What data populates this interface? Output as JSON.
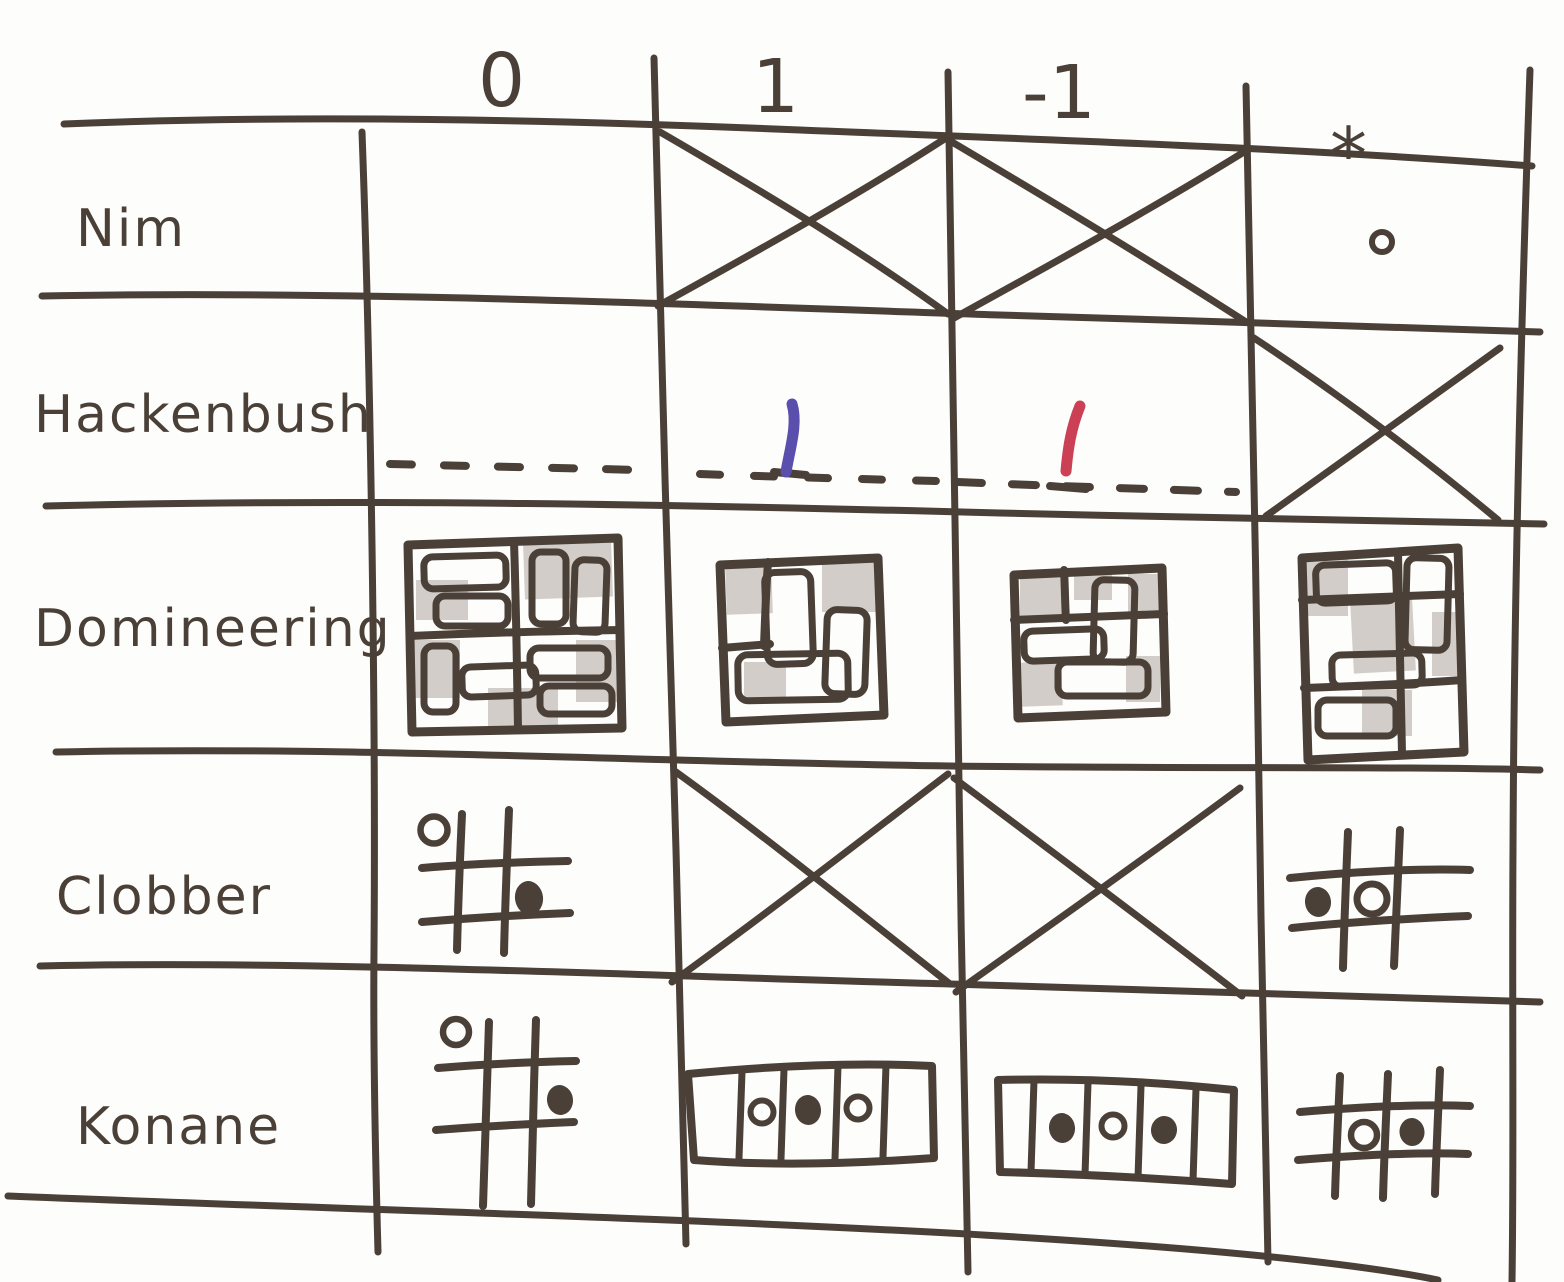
{
  "table": {
    "column_headers": [
      {
        "id": "zero",
        "label": "0"
      },
      {
        "id": "one",
        "label": "1"
      },
      {
        "id": "neg-one",
        "label": "-1"
      },
      {
        "id": "star",
        "label": "*"
      }
    ],
    "rows": [
      {
        "game": "Nim",
        "cells": [
          {
            "col": "0",
            "content": "empty cell (zero game)"
          },
          {
            "col": "1",
            "content": "crossed out — no Nim position has value 1"
          },
          {
            "col": "-1",
            "content": "crossed out — no Nim position has value -1"
          },
          {
            "col": "*",
            "content": "single stone (heap of one)"
          }
        ]
      },
      {
        "game": "Hackenbush",
        "cells": [
          {
            "col": "0",
            "content": "bare dashed ground line"
          },
          {
            "col": "1",
            "content": "one blue edge standing on the ground"
          },
          {
            "col": "-1",
            "content": "one red edge standing on the ground"
          },
          {
            "col": "*",
            "content": "crossed out — no such Hackenbush position"
          }
        ]
      },
      {
        "game": "Domineering",
        "cells": [
          {
            "col": "0",
            "content": "4x4 board densely packed with dominoes, pencil shading"
          },
          {
            "col": "1",
            "content": "3x3 board with dominoes and shaded squares"
          },
          {
            "col": "-1",
            "content": "3x3 board with dominoes and shaded squares"
          },
          {
            "col": "*",
            "content": "3x4 board with dominoes and shaded squares"
          }
        ]
      },
      {
        "game": "Clobber",
        "cells": [
          {
            "col": "0",
            "content": "small grid with one white stone (top left) and one black stone (middle right)"
          },
          {
            "col": "1",
            "content": "crossed out — impossible"
          },
          {
            "col": "-1",
            "content": "crossed out — impossible"
          },
          {
            "col": "*",
            "content": "small grid with one black stone (middle left) and one white stone (center)"
          }
        ]
      },
      {
        "game": "Konane",
        "cells": [
          {
            "col": "0",
            "content": "small grid with one white stone (top left) and one black stone (upper right)"
          },
          {
            "col": "1",
            "content": "1x5 strip with stones white, black, white"
          },
          {
            "col": "-1",
            "content": "1x5 strip with stones black, white, black"
          },
          {
            "col": "*",
            "content": "small grid with one white stone and one black stone in the middle row"
          }
        ]
      }
    ]
  },
  "colors": {
    "ink": "#4a4038",
    "paper": "#fdfdfb",
    "pencil": "#aba29a",
    "blue": "#5b4fae",
    "red": "#cc4055"
  }
}
